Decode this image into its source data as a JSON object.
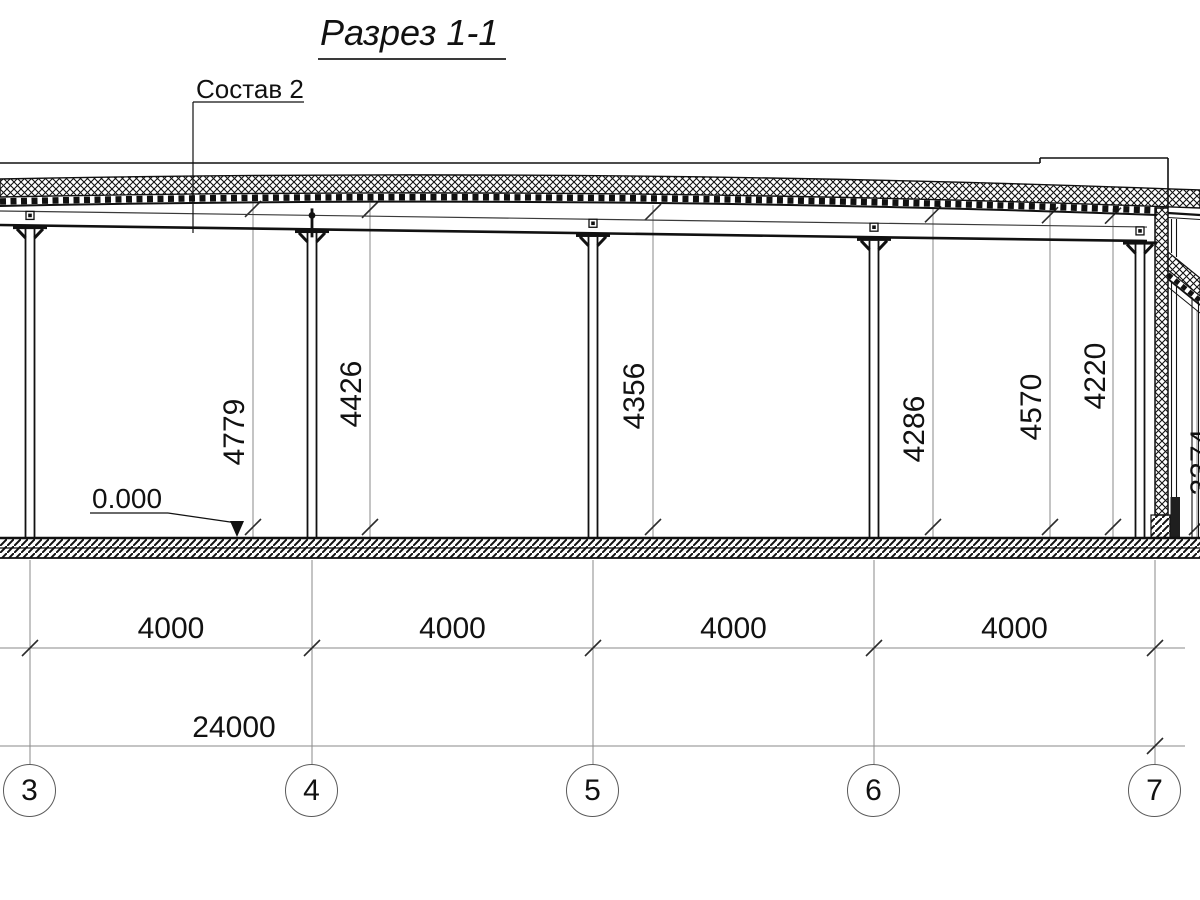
{
  "title": "Разрез 1-1",
  "callout_label": "Состав 2",
  "level_mark": "0.000",
  "height_dimensions": [
    "4779",
    "4426",
    "4356",
    "4286",
    "4570",
    "4220",
    "3374"
  ],
  "bay_dimensions": [
    "4000",
    "4000",
    "4000",
    "4000"
  ],
  "total_dimension": "24000",
  "axis_labels": [
    "3",
    "4",
    "5",
    "6",
    "7"
  ],
  "colors": {
    "line": "#111111",
    "dimension": "#8a8a8a",
    "tick": "#2b2b2b",
    "background": "#ffffff"
  }
}
